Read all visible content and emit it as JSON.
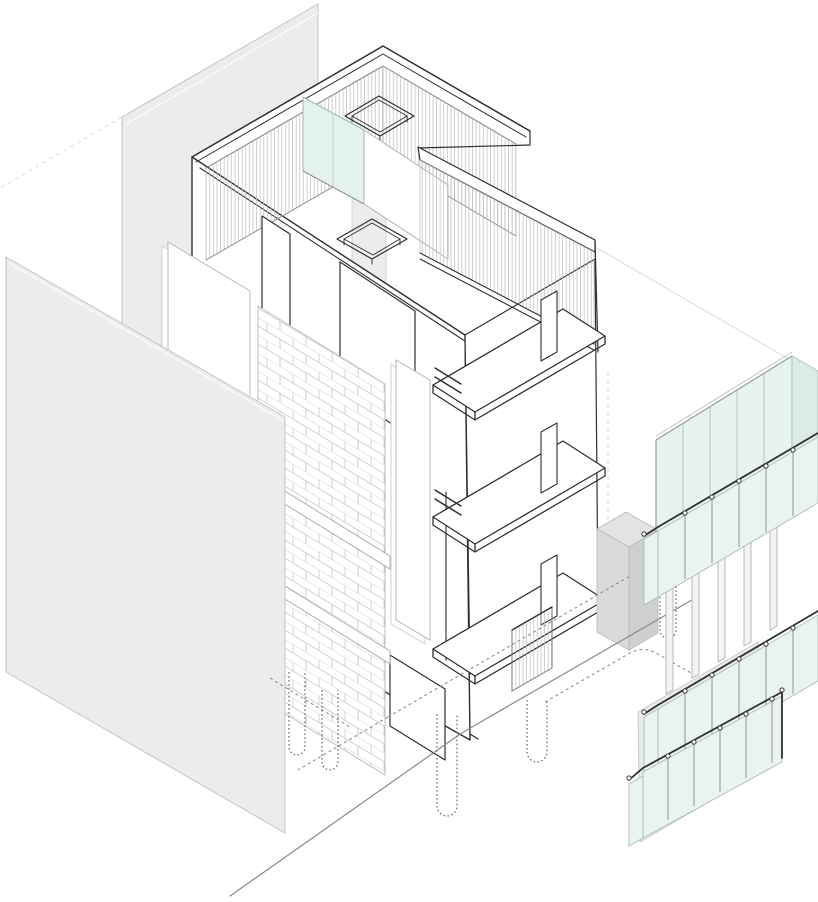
{
  "title": "Exploded axonometric diagram of a four-storey building",
  "colors": {
    "background": "#ffffff",
    "line_dark": "#2f2f2f",
    "line_mid": "#8a8a8a",
    "line_light": "#c7c7c7",
    "ghost": "#dcdcdc",
    "dash": "#868686",
    "pile": "#6b6b6b",
    "panel_gray": "#ececec",
    "panel_gray_edge": "#c4c4c4",
    "box_top": "#e3e3e3",
    "box_left": "#dadada",
    "box_right": "#cfcfcf",
    "base_panel": "#eaeaea",
    "glass_band": "#e7f3ee",
    "glass_band_side": "#dcebe5",
    "glass_rail": "#e9f4f0",
    "glass_pent": "#e4f2ec",
    "hatch_line": "#bcbcbc",
    "brick_line": "#cccccc",
    "mullion_fill": "#f4f4f4"
  },
  "components": [
    "party-wall-upper",
    "party-wall-lower",
    "roof-terrace",
    "roof-parapet-hatch",
    "skylight",
    "penthouse-glass",
    "right-wing-parapet",
    "left-facade-wall",
    "window-opening",
    "brick-veneer-panel",
    "floor-slab-strip",
    "wall-panel",
    "balcony-slab",
    "wall-fin",
    "service-box",
    "ground-grille",
    "foundation-pile",
    "ground-slab-edge",
    "ghost-guide-line",
    "glass-curtain-band",
    "facade-mullion",
    "balustrade-rail",
    "balustrade-glass",
    "rail-finial",
    "base-gray-panel"
  ]
}
